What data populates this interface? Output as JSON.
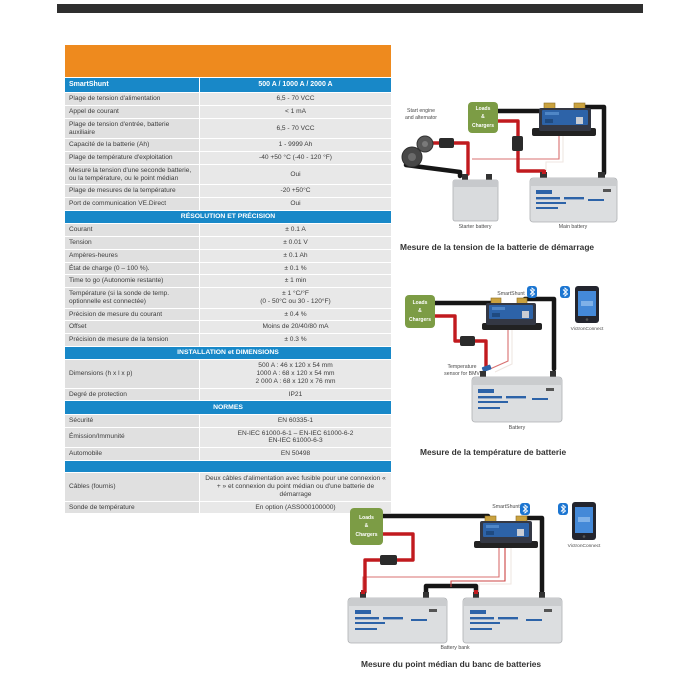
{
  "table": {
    "header": {
      "left": "SmartShunt",
      "right": "500 A / 1000 A / 2000 A"
    },
    "sections": [
      {
        "header": "",
        "rows": [
          {
            "label": "Plage de tension d'alimentation",
            "value": "6,5 - 70 VCC"
          },
          {
            "label": "Appel de courant",
            "value": "< 1 mA"
          },
          {
            "label": "Plage de tension d'entrée, batterie auxiliaire",
            "value": "6,5 - 70 VCC"
          },
          {
            "label": "Capacité de la batterie (Ah)",
            "value": "1 - 9999 Ah"
          },
          {
            "label": "Plage de température d'exploitation",
            "value": "-40 +50 °C  (-40 - 120 °F)"
          },
          {
            "label": "Mesure la tension d'une seconde batterie, ou la température, ou le point médian",
            "value": "Oui"
          },
          {
            "label": "Plage de mesures de la température",
            "value": "-20 +50°C"
          },
          {
            "label": "Port de communication VE.Direct",
            "value": "Oui"
          }
        ]
      },
      {
        "header": "RÉSOLUTION ET PRÉCISION",
        "rows": [
          {
            "label": "Courant",
            "value": "± 0.1 A"
          },
          {
            "label": "Tension",
            "value": "± 0.01 V"
          },
          {
            "label": "Ampères-heures",
            "value": "± 0.1 Ah"
          },
          {
            "label": "État de charge (0 – 100 %).",
            "value": "± 0.1 %"
          },
          {
            "label": "Time to go (Autonomie restante)",
            "value": "± 1 min"
          },
          {
            "label": "Température (si la sonde de temp. optionnelle est connectée)",
            "value": "± 1 °C/°F\n(0 - 50°C ou 30 - 120°F)"
          },
          {
            "label": "Précision de mesure du courant",
            "value": "± 0.4 %"
          },
          {
            "label": "Offset",
            "value": "Moins de 20/40/80 mA"
          },
          {
            "label": "Précision de mesure de la tension",
            "value": "± 0.3 %"
          }
        ]
      },
      {
        "header": "INSTALLATION et DIMENSIONS",
        "rows": [
          {
            "label": "Dimensions (h x l x p)",
            "value": "500 A : 46 x 120 x 54 mm\n1000 A : 68 x 120 x 54 mm\n2 000 A : 68 x 120 x 76 mm"
          },
          {
            "label": "Degré de protection",
            "value": "IP21"
          }
        ]
      },
      {
        "header": "NORMES",
        "rows": [
          {
            "label": "Sécurité",
            "value": "EN 60335-1"
          },
          {
            "label": "Émission/Immunité",
            "value": "EN-IEC 61000-6-1 – EN-IEC 61000-6-2\nEN-IEC 61000-6-3"
          },
          {
            "label": "Automobile",
            "value": "EN 50498"
          }
        ]
      },
      {
        "header": "",
        "rows": [
          {
            "label": "Câbles (fournis)",
            "value": "Deux câbles d'alimentation avec fusible pour une connexion « + » et connexion du point médian ou d'une batterie de démarrage"
          },
          {
            "label": "Sonde de température",
            "value": "En option (ASS000100000)"
          }
        ]
      }
    ]
  },
  "diagrams": [
    {
      "caption": "Mesure de la tension de la batterie de démarrage",
      "labels": {
        "loads": "Loads\n&\nChargers",
        "start_engine": "Start engine\nand alternator",
        "starter_battery": "Starter battery",
        "main_battery": "Main battery"
      }
    },
    {
      "caption": "Mesure de la température de batterie",
      "labels": {
        "loads": "Loads\n&\nChargers",
        "smartshunt": "SmartShunt",
        "victron_connect": "VictronConnect",
        "temp_sensor": "Temperature\nsensor for BMV",
        "battery": "Battery"
      }
    },
    {
      "caption": "Mesure du point médian du banc de batteries",
      "labels": {
        "loads": "Loads\n&\nChargers",
        "smartshunt": "SmartShunt",
        "victron_connect": "VictronConnect",
        "battery_bank": "Battery bank"
      }
    }
  ],
  "colors": {
    "accent_orange": "#EE8A1E",
    "accent_blue": "#1888C8",
    "cable_red": "#C11A1E",
    "cable_black": "#161616",
    "loads_green": "#7C9C45",
    "bluetooth_blue": "#1B75D1"
  }
}
